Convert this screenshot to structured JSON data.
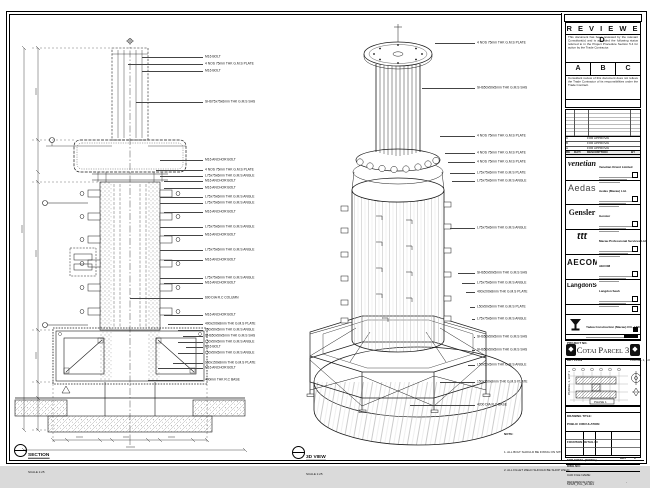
{
  "sheet": {
    "disclaimer": "DO NOT SCALE DRAWING. VERIFY ALL DIMENSIONS ON SITE.",
    "note_title": "NOTE:",
    "note_items": [
      "1. ALL BOLT SHOULD BE FIXING ON SITE.",
      "2. ALL FILLET WELD SHOULD BE SHOP WELD."
    ]
  },
  "stamp": {
    "title": "R E V I E W E D",
    "para1": "This document has been reviewed by the relevant Consultant(s) and is accorded the following status referred to in the Project Procedure Section 5.4 for action by the Trade Contractor.",
    "options": [
      "A",
      "B",
      "C"
    ],
    "para2": "Consultant review of this document does not relieve the Trade Contractor of its responsibilities under the Trade Contract.",
    "date_label": "Date :"
  },
  "revisions": {
    "headers": [
      "REV",
      "DATE",
      "DESCRIPTION",
      "BY"
    ],
    "rows": [
      {
        "rev": "C",
        "date": "",
        "description": "FOR APPROVAL",
        "by": ""
      },
      {
        "rev": "B",
        "date": "",
        "description": "FOR APPROVAL",
        "by": ""
      },
      {
        "rev": "A",
        "date": "",
        "description": "FOR APPROVAL",
        "by": ""
      }
    ]
  },
  "companies": [
    {
      "logo": "venetian",
      "name": "Venetian Orient Limited"
    },
    {
      "logo": "Aedas",
      "name": "Aedas (Macau) Ltd."
    },
    {
      "logo": "Gensler",
      "name": "Gensler"
    },
    {
      "logo": "ttt",
      "name": "Macau Professional Services Ltd."
    },
    {
      "logo": "AECOM",
      "name": "AECOM"
    },
    {
      "logo": "LangdonSeah",
      "name": "Langdon Seah"
    }
  ],
  "contractor": {
    "name": "Yadea Construction (Macau) CO., LTD.",
    "project_no_label": "PROJECT NO."
  },
  "project": {
    "title": "Cotai Parcel 3",
    "ornament": "◆"
  },
  "key_plan": {
    "label": "KEY PLAN",
    "parcel": "PARCEL 1, LOT 2",
    "parcel_side": "PARCEL 1, LOT 1",
    "phase": "PHASE 1"
  },
  "title_block": {
    "drawing_title_label": "DRAWING TITLE:",
    "title_lines": [
      "PUBLIC CIRCULATION",
      "FOUNTAIN DETAIL IN",
      "FOR STEEL (FIXING)"
    ],
    "f1_label": "DESIGNED",
    "f1_value": "",
    "f2_label": "DRAWN",
    "f2_value": "LHO",
    "f3_label": "CHECKED",
    "f3_value": "-",
    "f4_label": "DATE",
    "f4_value": "14-12-2015",
    "f5_label": "APPROVED",
    "f5_value": "-",
    "f6_label": "SCALE",
    "f6_value": "AS SHOWN",
    "dwg_no_label": "DWG NO:",
    "dwg_no": "51525_PCL_95-004",
    "rev_label": "REV",
    "rev": "C",
    "cad_label": "CAD FILE NAME:",
    "cad_file": "51525_PCL_95-004.dwg",
    "ref_label": "REFERENCE DWG:",
    "ref_value": "-"
  },
  "section_view": {
    "title": "SECTION",
    "scale": "SCALE 1:25",
    "labels": [
      {
        "y": 47,
        "lx": 134,
        "text": "M16 BOLT"
      },
      {
        "y": 54,
        "lx": 120,
        "text": "4 NOS 75mm THK G.M.S PLATE"
      },
      {
        "y": 61,
        "lx": 134,
        "text": "M16 BOLT"
      },
      {
        "y": 92,
        "lx": 128,
        "text": "SHS75x75x6mm THK G.M.S SHS"
      },
      {
        "y": 150,
        "lx": 152,
        "text": "M16 ANCHOR BOLT"
      },
      {
        "y": 160,
        "lx": 148,
        "text": "4 NOS 75mm THK G.M.S PLATE"
      },
      {
        "y": 166,
        "lx": 152,
        "text": "L75x75x6mm THK G.M.S ANGLE"
      },
      {
        "y": 171,
        "lx": 156,
        "text": "M16 ANCHOR BOLT"
      },
      {
        "y": 178,
        "lx": 156,
        "text": "M16 ANCHOR BOLT"
      },
      {
        "y": 187,
        "lx": 152,
        "text": "L75x75x6mm THK G.M.S ANGLE"
      },
      {
        "y": 193,
        "lx": 152,
        "text": "L75x75x6mm THK G.M.S ANGLE"
      },
      {
        "y": 202,
        "lx": 156,
        "text": "M16 ANCHOR BOLT"
      },
      {
        "y": 217,
        "lx": 152,
        "text": "L75x75x6mm THK G.M.S ANGLE"
      },
      {
        "y": 225,
        "lx": 156,
        "text": "M16 ANCHOR BOLT"
      },
      {
        "y": 240,
        "lx": 152,
        "text": "L75x75x6mm THK G.M.S ANGLE"
      },
      {
        "y": 250,
        "lx": 156,
        "text": "M16 ANCHOR BOLT"
      },
      {
        "y": 268,
        "lx": 152,
        "text": "L75x75x6mm THK G.M.S ANGLE"
      },
      {
        "y": 273,
        "lx": 156,
        "text": "M16 ANCHOR BOLT"
      },
      {
        "y": 288,
        "lx": 122,
        "text": "600 DIA R.C COLUMN"
      },
      {
        "y": 305,
        "lx": 156,
        "text": "M16 ANCHOR BOLT"
      },
      {
        "y": 314,
        "lx": 160,
        "text": "400x200x8mm THK G.M.S PLATE"
      },
      {
        "y": 320,
        "lx": 170,
        "text": "L50x50x5mm THK G.M.S ANGLE"
      },
      {
        "y": 326,
        "lx": 175,
        "text": "SHS50x50x5mm THK G.M.S SHS"
      },
      {
        "y": 332,
        "lx": 170,
        "text": "L50x50x5mm THK G.M.S ANGLE"
      },
      {
        "y": 337,
        "lx": 178,
        "text": "M16 BOLT"
      },
      {
        "y": 343,
        "lx": 170,
        "text": "L50x50x5mm THK G.M.S ANGLE"
      },
      {
        "y": 353,
        "lx": 165,
        "text": "150x150x8mm THK G.M.S PLATE"
      },
      {
        "y": 358,
        "lx": 150,
        "text": "M16 ANCHOR BOLT"
      },
      {
        "y": 370,
        "lx": 140,
        "text": "400mm THK R.C BASE"
      }
    ]
  },
  "iso_view": {
    "title": "3D VIEW",
    "scale": "SCALE 1:25",
    "labels": [
      {
        "y": 33,
        "lx": 145,
        "text": "4 NOS 75mm THK G.M.S PLATE"
      },
      {
        "y": 78,
        "lx": 132,
        "text": "SHS50x50x5mm THK G.M.S SHS"
      },
      {
        "y": 126,
        "lx": 150,
        "text": "4 NOS 75mm THK G.M.S PLATE"
      },
      {
        "y": 143,
        "lx": 155,
        "text": "4 NOS 75mm THK G.M.S PLATE"
      },
      {
        "y": 152,
        "lx": 158,
        "text": "4 NOS 75mm THK G.M.S PLATE"
      },
      {
        "y": 163,
        "lx": 160,
        "text": "L75x75x6mm THK G.M.S PLATE"
      },
      {
        "y": 171,
        "lx": 162,
        "text": "L75x75x6mm THK G.M.S ANGLE"
      },
      {
        "y": 218,
        "lx": 160,
        "text": "L75x75x6mm THK G.M.S ANGLE"
      },
      {
        "y": 263,
        "lx": 168,
        "text": "SHS50x50x5mm THK G.M.S SHS"
      },
      {
        "y": 273,
        "lx": 172,
        "text": "L75x75x6mm THK G.M.S ANGLE"
      },
      {
        "y": 282,
        "lx": 176,
        "text": "400x200x8mm THK G.M.S PLATE"
      },
      {
        "y": 297,
        "lx": 180,
        "text": "L50x50x5mm THK G.M.S PLATE"
      },
      {
        "y": 309,
        "lx": 182,
        "text": "L75x75x6mm THK G.M.S ANGLE"
      },
      {
        "y": 327,
        "lx": 184,
        "text": "SHS50x50x5mm THK G.M.S SHS"
      },
      {
        "y": 340,
        "lx": 182,
        "text": "SHS50x50x5mm THK G.M.S SHS"
      },
      {
        "y": 355,
        "lx": 178,
        "text": "L50x50x5mm THK G.M.S ANGLE"
      },
      {
        "y": 372,
        "lx": 150,
        "text": "150x150x8mm THK G.M.S PLATE"
      },
      {
        "y": 395,
        "lx": 120,
        "text": "4200 DIA R.C BASE"
      }
    ]
  }
}
